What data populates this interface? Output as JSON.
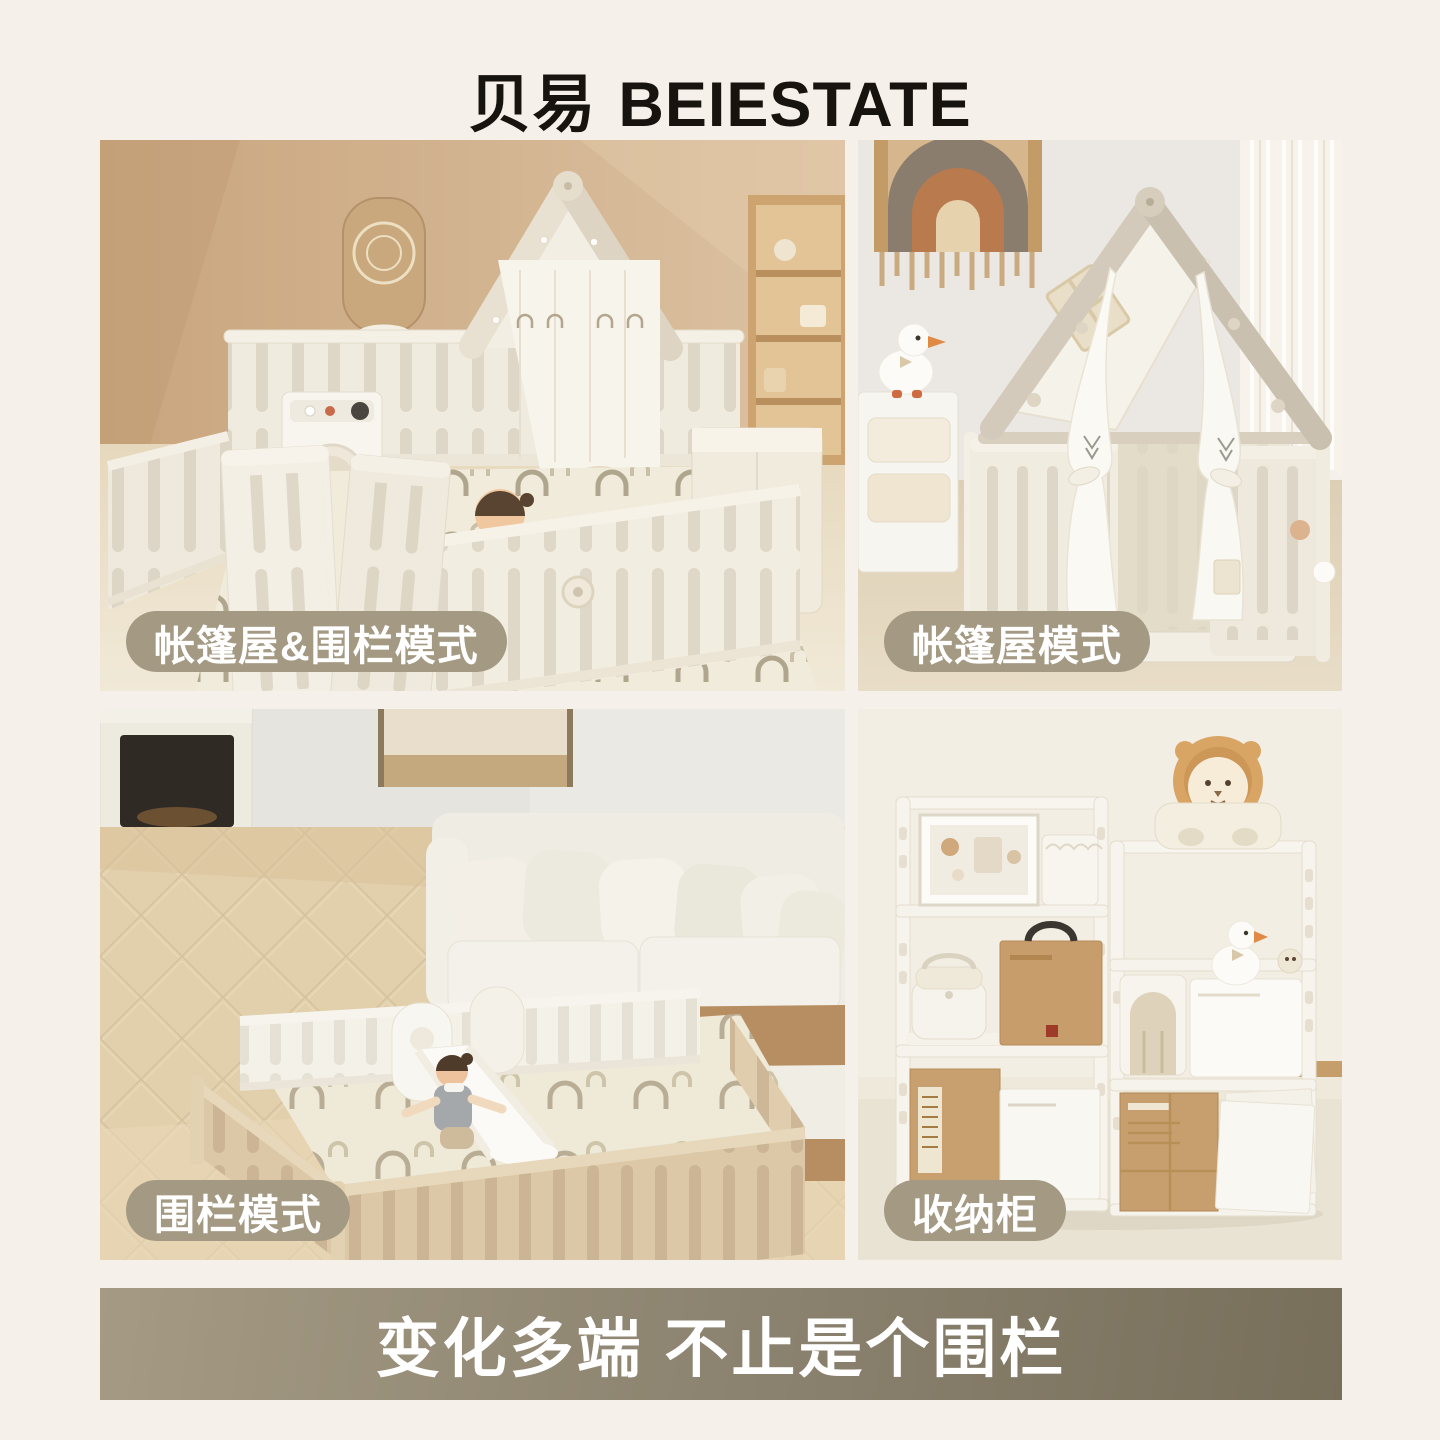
{
  "header": {
    "brand_cn": "贝易",
    "brand_en": "BEIESTATE"
  },
  "photos": [
    {
      "label": "帐篷屋&围栏模式"
    },
    {
      "label": "帐篷屋模式"
    },
    {
      "label": "围栏模式"
    },
    {
      "label": "收纳柜"
    }
  ],
  "banner": {
    "title": "变化多端 不止是个围栏"
  },
  "colors": {
    "page_bg": "#f5f0e9",
    "logo_text": "#17140f",
    "label_pill_bg": "#a49a83",
    "label_pill_text": "#ffffff",
    "banner_gradient_left": "#a59b84",
    "banner_gradient_right": "#786f5b",
    "banner_text": "#ffffff"
  }
}
